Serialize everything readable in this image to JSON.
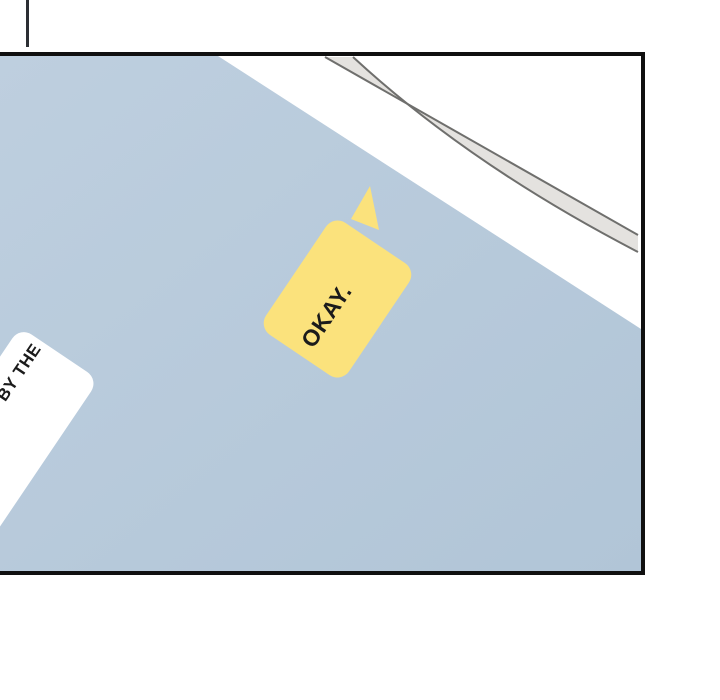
{
  "bubbles": {
    "okay": {
      "text": "OKAY."
    },
    "partial": {
      "line1": "BY THE",
      "line2": "—"
    }
  },
  "colors": {
    "bubble_yellow": "#FBE27C",
    "surface_blue_light": "#BECFDF",
    "surface_blue_dark": "#B1C5D7",
    "panel_border": "#101010",
    "stripe_fill": "#E4E2DF",
    "stripe_edge": "#6F6F6D",
    "text": "#1B1B1B",
    "background": "#FFFFFF"
  }
}
